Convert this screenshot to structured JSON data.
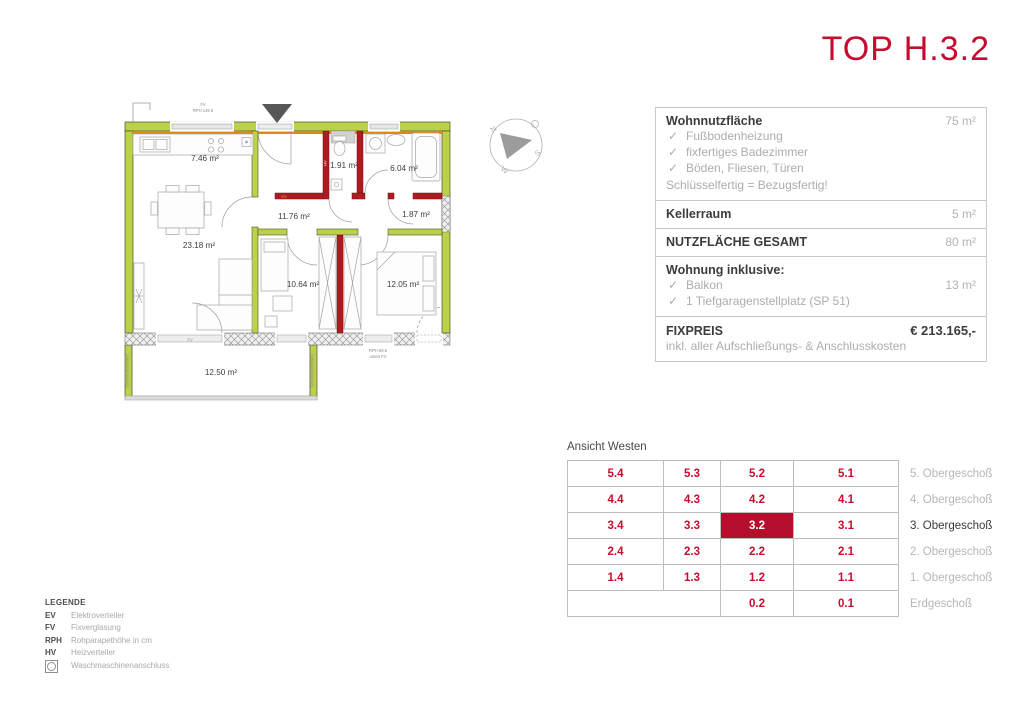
{
  "title": "TOP H.3.2",
  "info_panel": {
    "sections": [
      {
        "label": "Wohnnutzfläche",
        "value": "75 m²",
        "items": [
          "Fußbodenheizung",
          "fixfertiges Badezimmer",
          "Böden, Fliesen, Türen"
        ],
        "note": "Schlüsselfertig = Bezugsfertig!"
      },
      {
        "label": "Kellerraum",
        "value": "5 m²"
      },
      {
        "label": "NUTZFLÄCHE GESAMT",
        "value": "80 m²"
      },
      {
        "label": "Wohnung inklusive:",
        "item1": "Balkon",
        "item1_value": "13 m²",
        "item2": "1 Tiefgaragenstellplatz (SP 51)"
      },
      {
        "label": "FIXPREIS",
        "value": "€ 213.165,-",
        "note": "inkl. aller Aufschließungs- & Anschlusskosten"
      }
    ],
    "check_glyph": "✓"
  },
  "grid": {
    "caption": "Ansicht Westen",
    "rows": [
      {
        "cells": [
          "5.4",
          "5.3",
          "5.2",
          "5.1"
        ],
        "floor": "5. Obergeschoß"
      },
      {
        "cells": [
          "4.4",
          "4.3",
          "4.2",
          "4.1"
        ],
        "floor": "4. Obergeschoß"
      },
      {
        "cells": [
          "3.4",
          "3.3",
          "3.2",
          "3.1"
        ],
        "floor": "3. Obergeschoß"
      },
      {
        "cells": [
          "2.4",
          "2.3",
          "2.2",
          "2.1"
        ],
        "floor": "2. Obergeschoß"
      },
      {
        "cells": [
          "1.4",
          "1.3",
          "1.2",
          "1.1"
        ],
        "floor": "1. Obergeschoß"
      },
      {
        "cells": [
          "",
          "",
          "0.2",
          "0.1"
        ],
        "floor": "Erdgeschoß"
      }
    ],
    "accent_red": "#c40e2e",
    "highlight_bg": "#b50d2c"
  },
  "legend": {
    "title": "LEGENDE",
    "items": [
      {
        "key": "EV",
        "label": "Elektroverteiler"
      },
      {
        "key": "FV",
        "label": "Fixverglasung"
      },
      {
        "key": "RPH",
        "label": "Rohparapethöhe in cm"
      },
      {
        "key": "HV",
        "label": "Heizverteiler"
      }
    ],
    "washer_label": "Waschmaschinenanschluss"
  },
  "plan": {
    "rooms": {
      "kitchen": "7.46 m²",
      "living": "23.18 m²",
      "hall": "11.76 m²",
      "wc": "1.91 m²",
      "bath": "6.04 m²",
      "storage": "1.87 m²",
      "child": "10.64 m²",
      "bedroom": "12.05 m²",
      "balcony": "12.50 m²"
    },
    "annotations": {
      "top_fv": "FV",
      "top_rph": "RPH 149.5",
      "door_fv": "FV",
      "window_rph": "RPH 89.5",
      "window_rph2": "unten FV",
      "hv": "HV",
      "ev": "EV",
      "soundwall_left": "Schallschutzwand",
      "soundwall_right": "Schallschutzwand"
    },
    "compass": {
      "n": "N",
      "o": "O",
      "s": "S",
      "w": "W"
    },
    "colors": {
      "wall_green": "#bdd04a",
      "wall_orange": "#df8912",
      "wall_red": "#ad1a1f"
    }
  }
}
